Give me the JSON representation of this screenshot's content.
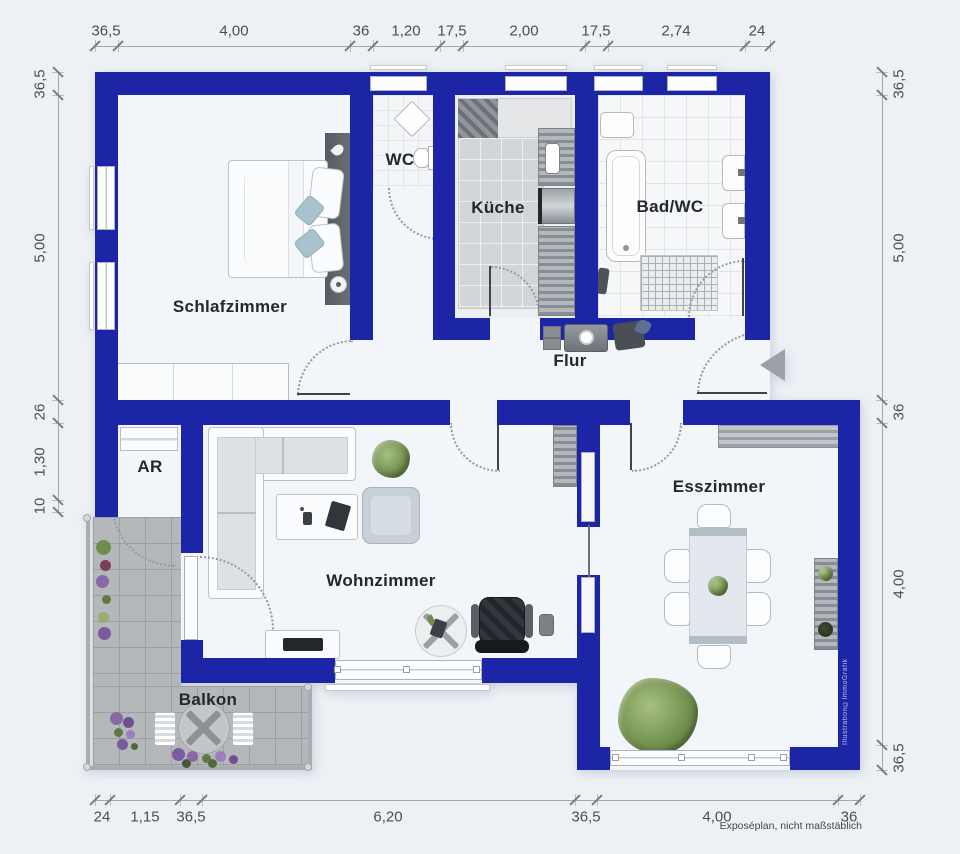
{
  "rooms": {
    "schlafzimmer": "Schlafzimmer",
    "wc": "WC",
    "kueche": "Küche",
    "bad": "Bad/WC",
    "flur": "Flur",
    "ar": "AR",
    "wohnzimmer": "Wohnzimmer",
    "esszimmer": "Esszimmer",
    "balkon": "Balkon"
  },
  "dimensions": {
    "top": [
      "36,5",
      "4,00",
      "36",
      "1,20",
      "17,5",
      "2,00",
      "17,5",
      "2,74",
      "24"
    ],
    "bottom": [
      "24",
      "1,15",
      "36,5",
      "6,20",
      "36,5",
      "4,00",
      "36"
    ],
    "left": [
      "36,5",
      "5,00",
      "26",
      "1,30",
      "10"
    ],
    "right": [
      "36,5",
      "5,00",
      "36",
      "4,00",
      "36,5"
    ]
  },
  "notes": {
    "footer": "Exposéplan, nicht maßstäblich",
    "credit": "Illustration©ImmoGrafik"
  },
  "colors": {
    "wall": "#1b25a6",
    "floor": "#f2f5f9",
    "background": "#edf1f5",
    "balcony_tile": "#b5b8ba",
    "dimension_text": "#4a4f55",
    "entrance_arrow": "#9aa0a6"
  }
}
